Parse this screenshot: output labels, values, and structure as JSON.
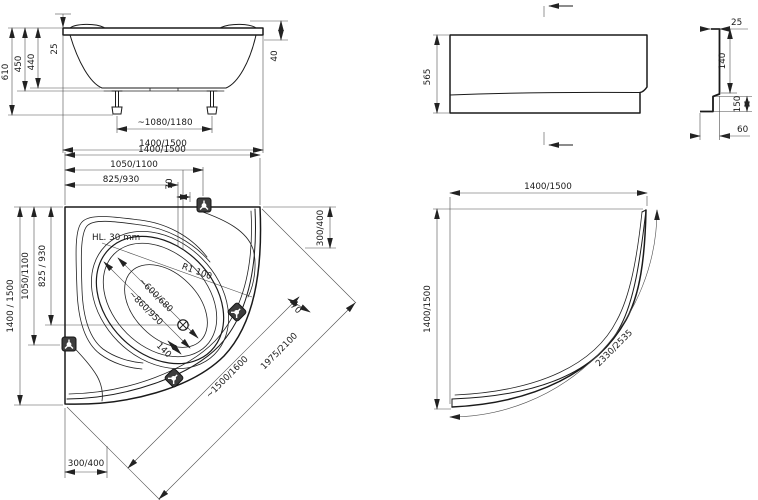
{
  "colors": {
    "line": "#1a1a1a",
    "dim": "#4d4d4d",
    "bracket_fill": "#3d3d3d",
    "background": "#ffffff"
  },
  "side": {
    "h610": "610",
    "h450": "450",
    "h440": "440",
    "rim25": "25",
    "lip40": "40",
    "feet": "~1080/1180",
    "len": "1400/1500"
  },
  "front": {
    "h565": "565"
  },
  "profile": {
    "w25": "25",
    "h140": "140",
    "h150": "150",
    "w60": "60"
  },
  "plan": {
    "top1400": "1400/1500",
    "top1050": "1050/1100",
    "top825": "825/930",
    "top70": "70",
    "left1400": "1400 / 1500",
    "left1050": "1050/1100",
    "left825": "825 / 930",
    "hl30": "HL. 30 mm",
    "r1100": "R1 100",
    "w600": "~600/680",
    "w860": "~860/950",
    "d140": "140",
    "right300": "300/400",
    "bottom300": "300/400",
    "rim1500": "~1500/1600",
    "diag1975": "1975/2100",
    "diag70": "70"
  },
  "apron": {
    "w1400": "1400/1500",
    "h1400": "1400/1500",
    "arc2330": "2330/2535"
  }
}
